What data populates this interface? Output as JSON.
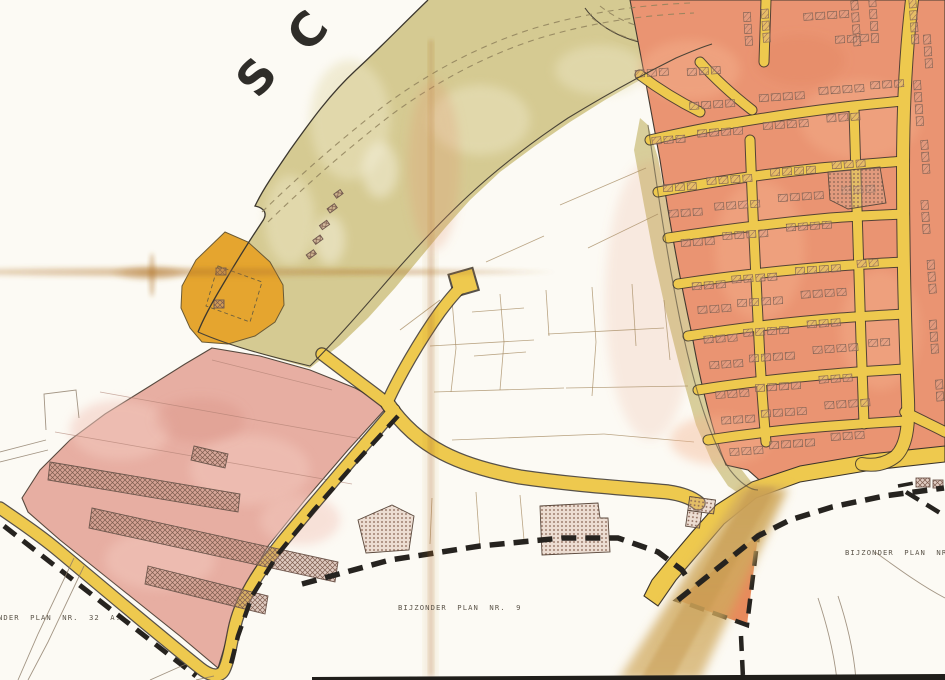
{
  "map": {
    "description": "Scanned Belgian/Dutch zoning plan sheet (watercolour on paper)",
    "river_letters": [
      "S",
      "C"
    ],
    "labels": {
      "bottom_left": "NDER PLAN NR. 32 A.",
      "bottom_center": "BIJZONDER PLAN NR. 9",
      "bottom_right": "BIJZONDER PLAN NR. V"
    }
  },
  "colors": {
    "paper": "#fcfaf4",
    "bank_khaki": "#d5ca92",
    "bank_khaki_light": "#e9e2bd",
    "road_yellow": "#eec94e",
    "road_casing": "#3a332a",
    "residential_salmon": "#ea9472",
    "residential_light": "#f4b28e",
    "industrial_pink": "#e7aea2",
    "industrial_light": "#f3c9be",
    "parcel_orange": "#e5a52f",
    "triangle_orange": "#e88a5c",
    "field_line": "#a4885f",
    "boundary_black": "#26231f",
    "dike_brown": "#8f815c",
    "stain_brown": "#b07428",
    "wash_tan": "#d0a95e",
    "label_gray": "#5c554a",
    "letter_black": "#2f2d29"
  }
}
